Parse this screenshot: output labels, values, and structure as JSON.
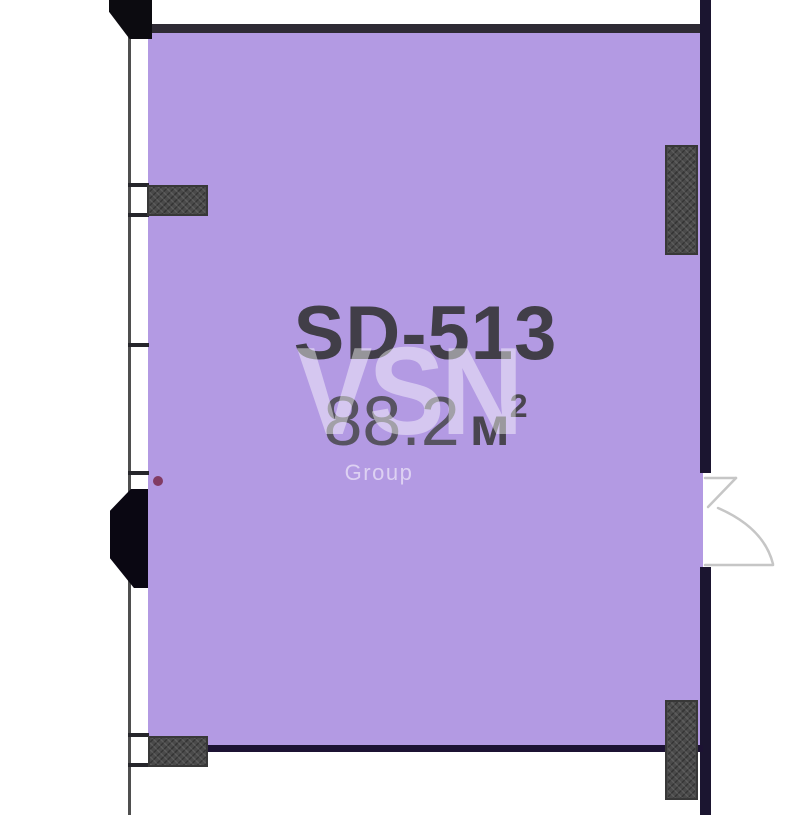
{
  "unit": {
    "id": "SD-513",
    "area_value": "88.2",
    "area_unit": "м",
    "area_unit_exponent": "2"
  },
  "watermark": {
    "brand": "VSN",
    "sub": "Group"
  },
  "colors": {
    "room_fill": "#b39ae3",
    "wall_dark": "#1b1530",
    "wall_top": "#2e2a34",
    "hatch_block": "#4a4a4a",
    "unit_id_text": "#413e48",
    "area_text": "#575361",
    "marker": "#7c3154"
  }
}
